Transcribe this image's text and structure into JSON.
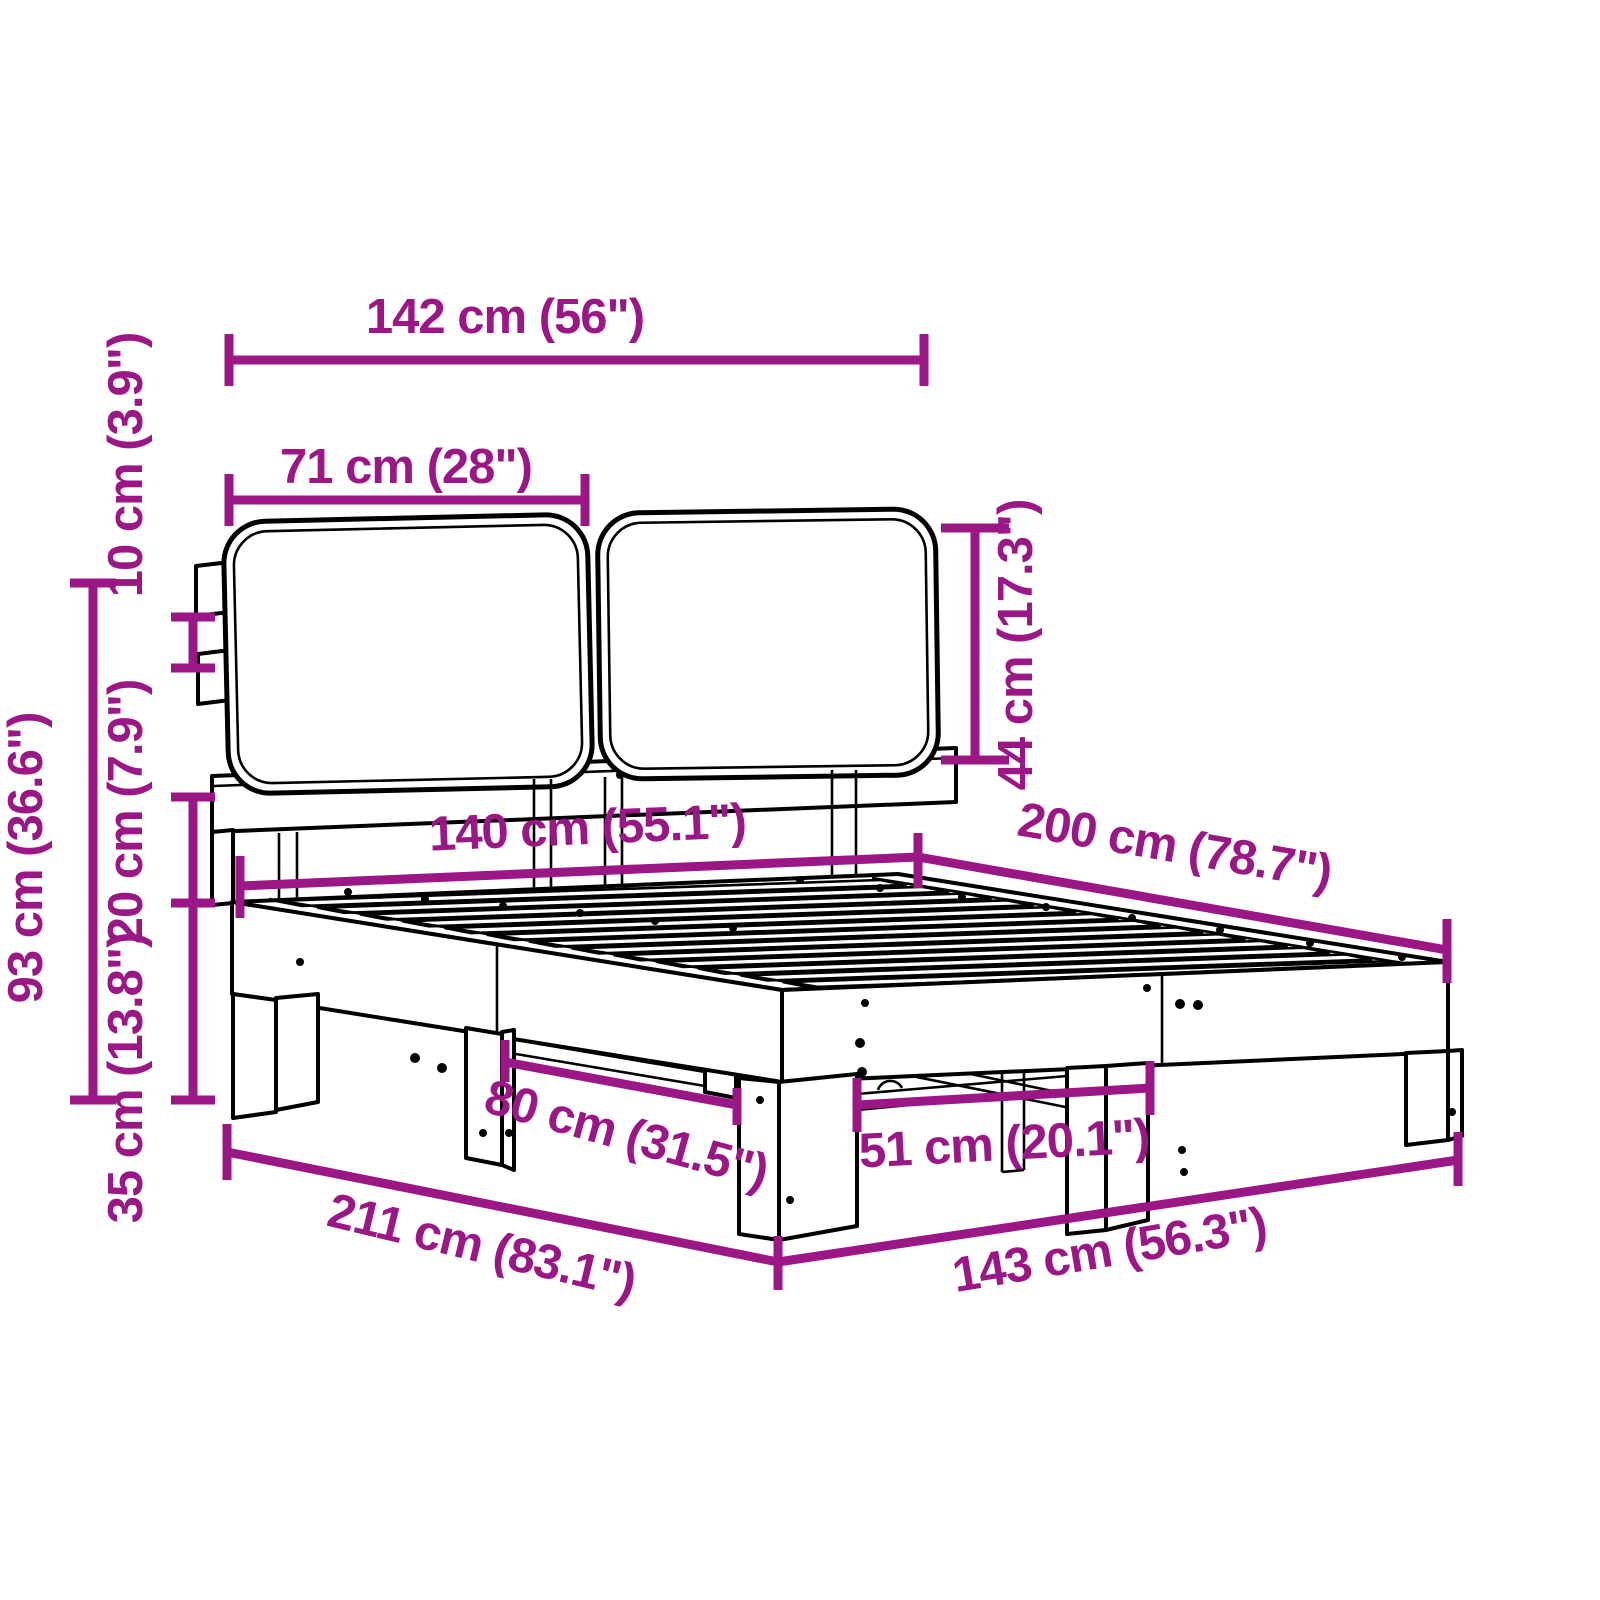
{
  "diagram": {
    "kind": "furniture-dimension-diagram",
    "subject": "bed frame with two headboard cushions, slatted base and legs",
    "colors": {
      "dimension_accent": "#9A1785",
      "drawing_outline": "#000000",
      "background": "#FFFFFF"
    },
    "dimensions": {
      "headboard_total_width": "142 cm (56\")",
      "cushion_width": "71 cm (28\")",
      "cushion_height": "44 cm (17.3\")",
      "bracket_spacing": "10 cm (3.9\")",
      "headboard_height": "93 cm (36.6\")",
      "clearance_under_headboard": "20 cm (7.9\")",
      "frame_height": "35 cm (13.8\")",
      "bed_width": "140 cm (55.1\")",
      "bed_length": "200 cm (78.7\")",
      "side_leg_spacing": "80 cm (31.5\")",
      "foot_leg_spacing": "51 cm (20.1\")",
      "overall_length": "211 cm (83.1\")",
      "overall_width": "143 cm (56.3\")"
    }
  }
}
